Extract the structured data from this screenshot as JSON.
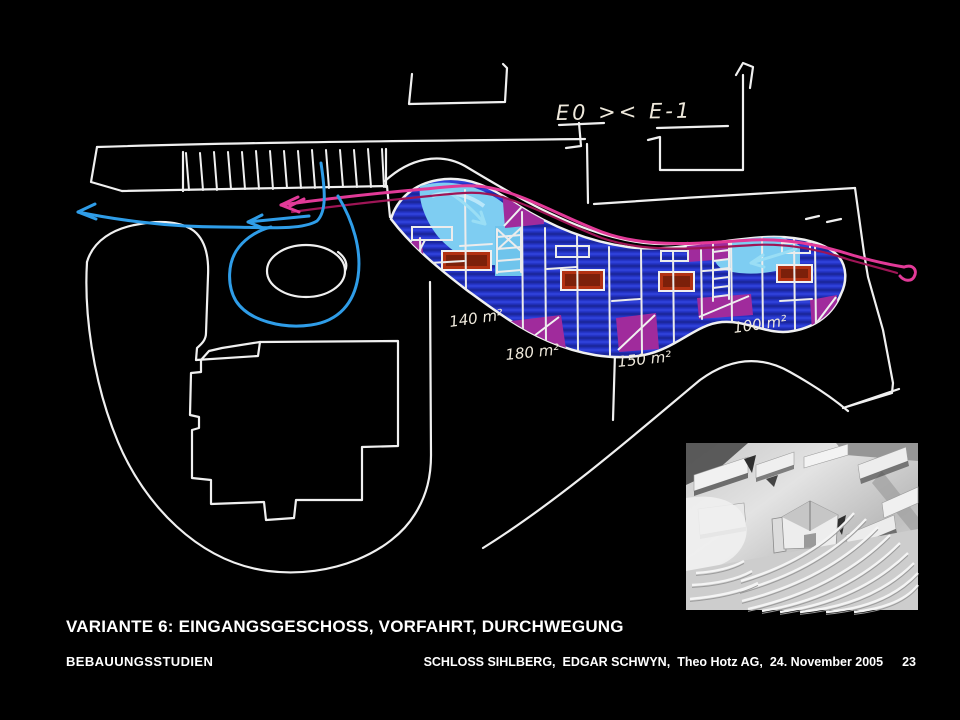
{
  "slide": {
    "title": "VARIANTE 6: EINGANGSGESCHOSS, VORFAHRT, DURCHWEGUNG",
    "category": "BEBAUUNGSSTUDIEN",
    "footer": {
      "project": "SCHLOSS SIHLBERG,",
      "author": "EDGAR SCHWYN,",
      "firm": "Theo Hotz AG,",
      "date": "24. November 2005",
      "page": "23"
    }
  },
  "sketch": {
    "level_annotation": "E0 >< E-1",
    "area_labels": [
      "140 m²",
      "180 m²",
      "150 m²",
      "100 m²"
    ],
    "colors": {
      "background": "#000000",
      "sketch_white": "#f0f0f0",
      "parcel_blue": "#2535c8",
      "parcel_magenta": "#a02b9c",
      "parcel_red": "#b23112",
      "highlight_cyan": "#7ecdf2",
      "route_pink": "#e23a98",
      "route_pink_dark": "#9e1556",
      "route_cyan": "#2f9de8"
    }
  }
}
